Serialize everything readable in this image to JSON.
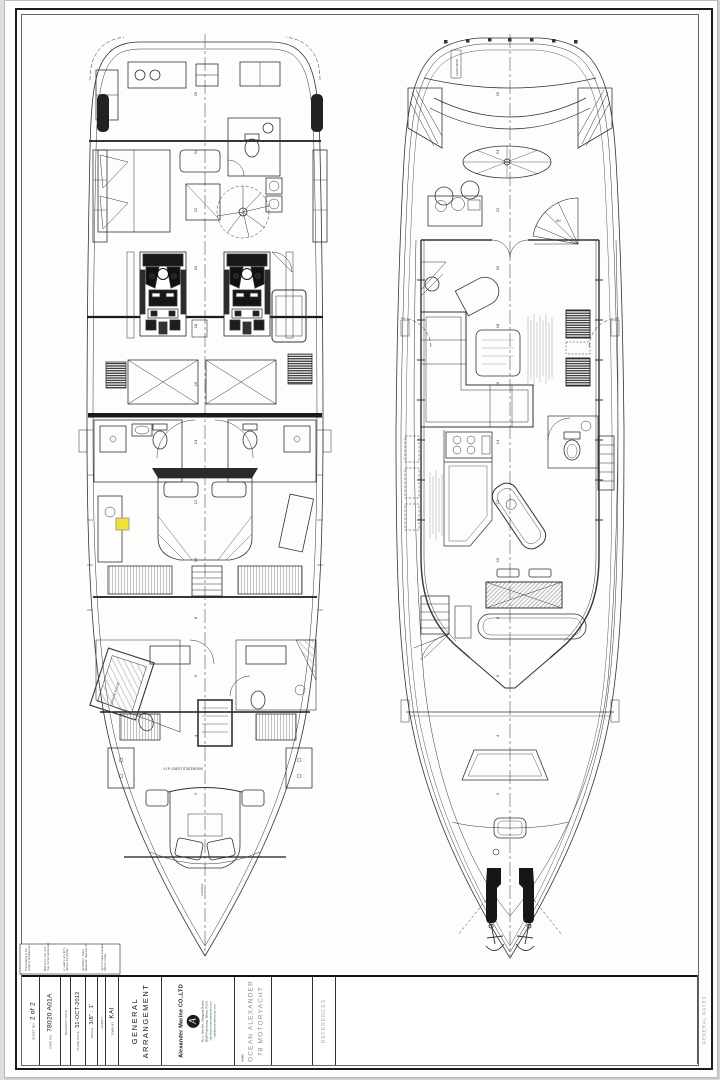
{
  "title_block": {
    "sheet_no_label": "SHEET NO",
    "sheet_no": "2 of 2",
    "dwg_no_label": "DWG NO",
    "dwg_no": "78020 A01A",
    "request_date_label": "REQUEST DATE",
    "request_date": "",
    "issue_date_label": "ISSUE DATE",
    "issue_date": "31-OCT-2012",
    "scale_label": "SCALE",
    "scale": "3/8\" : 1'",
    "verify_label": "VERIFY",
    "verify": "",
    "dwn_by_label": "DWN BY",
    "dwn_by": "KAI",
    "title_line1": "GENERAL",
    "title_line2": "ARRANGEMENT",
    "company_logo_letter": "A",
    "company_name": "Alexander Marine CO.,LTD",
    "company_address1": "No.1, Jietu Rd., Siaogang District,",
    "company_address2": "80665 Kaohsiung, Taiwan, R.O.C.",
    "company_web1": "http://www.oceanalexander.com",
    "company_web2": "mail@oceanalexander.com",
    "model_label": "NAME",
    "model_line1": "OCEAN ALEXANDER",
    "model_line2": "78  MOTORYACHT",
    "references_label": "REFERENCES",
    "general_notes_label": "GENERAL NOTES"
  },
  "disclaimer_lines": [
    "This drawing is the",
    "property of Alexander",
    "Marine Co., Ltd. and",
    "may not be reproduced",
    "or used in any form",
    "without the written",
    "permission. Ocean",
    "Alexander reserves the",
    "right to make changes",
    "without notice."
  ],
  "drawing": {
    "stations": [
      "2",
      "4",
      "6",
      "8",
      "10",
      "12",
      "14",
      "16",
      "18",
      "20",
      "22",
      "24",
      "26"
    ],
    "labels": {
      "vip_stateroom": "V.I.P. GUEST STATEROOM",
      "granite_floor": "GRANITE FLOOR",
      "locker": "LOCKER",
      "teak_deck": "TEAK DECK",
      "dn": "DN"
    }
  }
}
